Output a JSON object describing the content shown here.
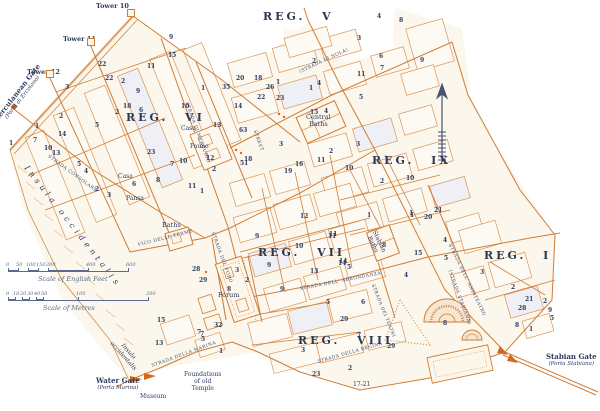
{
  "map": {
    "colors": {
      "street": "#cf7d36",
      "block_outline": "#dc9455",
      "text": "#2e3b5e",
      "scale": "#5a6a8e",
      "background": "#ffffff",
      "city_fill": "#fbf7ec"
    },
    "regions": [
      {
        "label": "REG. V",
        "x": 263,
        "y": 11
      },
      {
        "label": "REG. VI",
        "x": 126,
        "y": 112
      },
      {
        "label": "REG. VII",
        "x": 258,
        "y": 247
      },
      {
        "label": "REG. VIII",
        "x": 298,
        "y": 335
      },
      {
        "label": "REG. IX",
        "x": 372,
        "y": 155
      },
      {
        "label": "REG. I",
        "x": 484,
        "y": 250
      }
    ],
    "towers": [
      {
        "label": "Tower 10",
        "lx": 96,
        "ly": 3,
        "x": 130,
        "y": 12
      },
      {
        "label": "Tower 11",
        "lx": 63,
        "ly": 36,
        "x": 90,
        "y": 41
      },
      {
        "label": "Tower 12",
        "lx": 27,
        "ly": 69,
        "x": 49,
        "y": 73
      }
    ],
    "gates": [
      {
        "name": "herculanean-gate",
        "lines": [
          "Herculanean Gate",
          "(Porta di Ercolano)"
        ],
        "x": -16,
        "y": 88,
        "r": -52
      },
      {
        "name": "water-gate",
        "lines": [
          "Water Gate",
          "(Porta Marina)"
        ],
        "x": 96,
        "y": 377,
        "r": 0
      },
      {
        "name": "stabian-gate",
        "lines": [
          "Stabian Gate",
          "(Porta Stabiana)"
        ],
        "x": 546,
        "y": 353,
        "r": 0
      }
    ],
    "landmarks": [
      {
        "name": "central-baths",
        "lines": [
          "Central",
          "Baths"
        ],
        "x": 306,
        "y": 114,
        "cls": "big"
      },
      {
        "name": "baths",
        "lines": [
          "Baths"
        ],
        "x": 162,
        "y": 222,
        "cls": "big"
      },
      {
        "name": "forum",
        "lines": [
          "Forum"
        ],
        "x": 218,
        "y": 292,
        "cls": "big"
      },
      {
        "name": "museum",
        "lines": [
          "Museum"
        ],
        "x": 140,
        "y": 394,
        "cls": ""
      },
      {
        "name": "foundations-of-old-temple",
        "lines": [
          "Foundations",
          "of old",
          "Temple"
        ],
        "x": 184,
        "y": 372,
        "cls": ""
      },
      {
        "name": "casa-di-pansa-casa",
        "lines": [
          "Casa"
        ],
        "x": 118,
        "y": 174,
        "cls": ""
      },
      {
        "name": "casa-di-pansa-pansa",
        "lines": [
          "Pansa"
        ],
        "x": 126,
        "y": 196,
        "cls": ""
      },
      {
        "name": "casa-del-fauno-casa",
        "lines": [
          "Casa"
        ],
        "x": 181,
        "y": 126,
        "cls": ""
      },
      {
        "name": "casa-del-fauno-fauno",
        "lines": [
          "Fauno"
        ],
        "x": 190,
        "y": 144,
        "cls": ""
      },
      {
        "name": "stabian-baths",
        "lines": [
          "Stabian",
          "Baths"
        ],
        "x": 370,
        "y": 226,
        "r": 64,
        "cls": ""
      },
      {
        "name": "insula-occidentalis",
        "lines": [
          "Insula occidentalis"
        ],
        "x": 26,
        "y": 162,
        "r": 52,
        "cls": "italic spread"
      },
      {
        "name": "insula-occidentalis-small",
        "lines": [
          "Insula",
          "occidentalis"
        ],
        "x": 113,
        "y": 334,
        "r": 48,
        "cls": "italic"
      },
      {
        "name": "houses-17-21",
        "lines": [
          "17-21"
        ],
        "x": 353,
        "y": 382,
        "cls": ""
      }
    ],
    "street_labels": [
      {
        "text": "STRADA CONSOLARE",
        "x": 48,
        "y": 154,
        "r": 36
      },
      {
        "text": "VICO DELLE TERME",
        "x": 138,
        "y": 243,
        "r": -14
      },
      {
        "text": "STRADA DEL FORO",
        "x": 212,
        "y": 230,
        "r": 70
      },
      {
        "text": "STRADA DI MERCURIO",
        "x": 186,
        "y": 100,
        "r": 70
      },
      {
        "text": "STREET",
        "x": 254,
        "y": 128,
        "r": 70
      },
      {
        "text": "(STRADA DI NOLA)",
        "x": 300,
        "y": 70,
        "r": -25
      },
      {
        "text": "(STRADA STABIANA)",
        "x": 449,
        "y": 268,
        "r": 70
      },
      {
        "text": "STRADA DELL' ABBONDANZA",
        "x": 300,
        "y": 287,
        "r": -11
      },
      {
        "text": "STRADA DELLA MARINA",
        "x": 152,
        "y": 364,
        "r": -20
      },
      {
        "text": "STRADA DELLA REGINA",
        "x": 318,
        "y": 360,
        "r": -16
      },
      {
        "text": "STRADA DELL' ANFITEATRO",
        "x": 449,
        "y": 242,
        "r": 64
      },
      {
        "text": "STRADA DEI TEATRI",
        "x": 372,
        "y": 282,
        "r": 68
      }
    ],
    "numbers": [
      [
        172,
        39,
        "9"
      ],
      [
        171,
        57,
        "15"
      ],
      [
        150,
        68,
        "11"
      ],
      [
        101,
        66,
        "22"
      ],
      [
        108,
        80,
        "22"
      ],
      [
        68,
        89,
        "3"
      ],
      [
        124,
        83,
        "2"
      ],
      [
        139,
        93,
        "9"
      ],
      [
        126,
        108,
        "18"
      ],
      [
        142,
        112,
        "6"
      ],
      [
        118,
        114,
        "2"
      ],
      [
        184,
        108,
        "10"
      ],
      [
        204,
        90,
        "1"
      ],
      [
        225,
        89,
        "35"
      ],
      [
        239,
        80,
        "20"
      ],
      [
        257,
        80,
        "18"
      ],
      [
        279,
        84,
        "1"
      ],
      [
        269,
        89,
        "26"
      ],
      [
        260,
        99,
        "22"
      ],
      [
        279,
        100,
        "23"
      ],
      [
        237,
        108,
        "14"
      ],
      [
        216,
        127,
        "13"
      ],
      [
        242,
        132,
        "63"
      ],
      [
        62,
        118,
        "2"
      ],
      [
        38,
        128,
        "1"
      ],
      [
        98,
        127,
        "5"
      ],
      [
        61,
        136,
        "14"
      ],
      [
        36,
        142,
        "7"
      ],
      [
        47,
        150,
        "10"
      ],
      [
        55,
        155,
        "13"
      ],
      [
        12,
        145,
        "1"
      ],
      [
        80,
        166,
        "5"
      ],
      [
        87,
        173,
        "4"
      ],
      [
        98,
        191,
        "2"
      ],
      [
        110,
        197,
        "3"
      ],
      [
        135,
        186,
        "6"
      ],
      [
        159,
        182,
        "8"
      ],
      [
        173,
        166,
        "7"
      ],
      [
        182,
        163,
        "10"
      ],
      [
        150,
        154,
        "23"
      ],
      [
        209,
        160,
        "12"
      ],
      [
        215,
        171,
        "2"
      ],
      [
        191,
        188,
        "11"
      ],
      [
        203,
        193,
        "1"
      ],
      [
        243,
        165,
        "51"
      ],
      [
        247,
        161,
        "18"
      ],
      [
        282,
        146,
        "3"
      ],
      [
        287,
        173,
        "19"
      ],
      [
        380,
        18,
        "4"
      ],
      [
        360,
        40,
        "3"
      ],
      [
        423,
        62,
        "9"
      ],
      [
        402,
        22,
        "8"
      ],
      [
        315,
        63,
        "2"
      ],
      [
        320,
        85,
        "4"
      ],
      [
        312,
        90,
        "1"
      ],
      [
        383,
        70,
        "7"
      ],
      [
        382,
        58,
        "6"
      ],
      [
        360,
        76,
        "11"
      ],
      [
        362,
        99,
        "5"
      ],
      [
        313,
        114,
        "15"
      ],
      [
        327,
        113,
        "4"
      ],
      [
        359,
        146,
        "3"
      ],
      [
        348,
        170,
        "10"
      ],
      [
        332,
        153,
        "2"
      ],
      [
        320,
        162,
        "11"
      ],
      [
        298,
        166,
        "16"
      ],
      [
        383,
        183,
        "2"
      ],
      [
        409,
        180,
        "10"
      ],
      [
        370,
        217,
        "1"
      ],
      [
        413,
        217,
        "1"
      ],
      [
        427,
        219,
        "20"
      ],
      [
        437,
        212,
        "21"
      ],
      [
        385,
        247,
        "8"
      ],
      [
        258,
        238,
        "9"
      ],
      [
        298,
        248,
        "10"
      ],
      [
        332,
        236,
        "11"
      ],
      [
        270,
        267,
        "9"
      ],
      [
        342,
        263,
        "14"
      ],
      [
        313,
        273,
        "13"
      ],
      [
        238,
        272,
        "3"
      ],
      [
        248,
        282,
        "2"
      ],
      [
        283,
        291,
        "9"
      ],
      [
        230,
        291,
        "8"
      ],
      [
        195,
        271,
        "28"
      ],
      [
        202,
        282,
        "29"
      ],
      [
        217,
        327,
        "32"
      ],
      [
        200,
        334,
        "7"
      ],
      [
        160,
        322,
        "15"
      ],
      [
        331,
        238,
        "11"
      ],
      [
        341,
        265,
        "14"
      ],
      [
        350,
        269,
        "5"
      ],
      [
        329,
        304,
        "5"
      ],
      [
        364,
        304,
        "6"
      ],
      [
        343,
        321,
        "29"
      ],
      [
        360,
        337,
        "7"
      ],
      [
        304,
        352,
        "3"
      ],
      [
        390,
        348,
        "29"
      ],
      [
        351,
        370,
        "2"
      ],
      [
        315,
        376,
        "23"
      ],
      [
        303,
        218,
        "12"
      ],
      [
        446,
        325,
        "8"
      ],
      [
        412,
        215,
        "1"
      ],
      [
        446,
        242,
        "4"
      ],
      [
        417,
        255,
        "15"
      ],
      [
        447,
        260,
        "5"
      ],
      [
        483,
        274,
        "3"
      ],
      [
        407,
        277,
        "4"
      ],
      [
        514,
        289,
        "2"
      ],
      [
        528,
        301,
        "21"
      ],
      [
        521,
        310,
        "28"
      ],
      [
        546,
        303,
        "2"
      ],
      [
        551,
        312,
        "9"
      ],
      [
        553,
        320,
        "5"
      ],
      [
        518,
        327,
        "8"
      ],
      [
        532,
        331,
        "1"
      ],
      [
        158,
        345,
        "13"
      ],
      [
        203,
        336,
        "7"
      ],
      [
        204,
        341,
        "5"
      ],
      [
        222,
        353,
        "1"
      ]
    ],
    "scales": {
      "feet": {
        "caption": "Scale of English Feet",
        "y": 271,
        "x0": 8,
        "px_per_unit": 0.2,
        "ticks": [
          [
            "0",
            0
          ],
          [
            "50",
            50
          ],
          [
            "100",
            100
          ],
          [
            "150",
            150
          ],
          [
            "200",
            200
          ],
          [
            "400",
            400
          ],
          [
            "600",
            600
          ]
        ]
      },
      "metres": {
        "caption": "Scale of Metres",
        "y": 300,
        "x0": 8,
        "px_per_unit": 0.7,
        "ticks": [
          [
            "0",
            0
          ],
          [
            "10",
            10
          ],
          [
            "20",
            20
          ],
          [
            "30",
            30
          ],
          [
            "40",
            40
          ],
          [
            "50",
            50
          ],
          [
            "100",
            100
          ],
          [
            "200",
            200
          ]
        ]
      }
    },
    "north_arrow": {
      "x": 442,
      "y_top": 86,
      "y_bottom": 162
    }
  }
}
